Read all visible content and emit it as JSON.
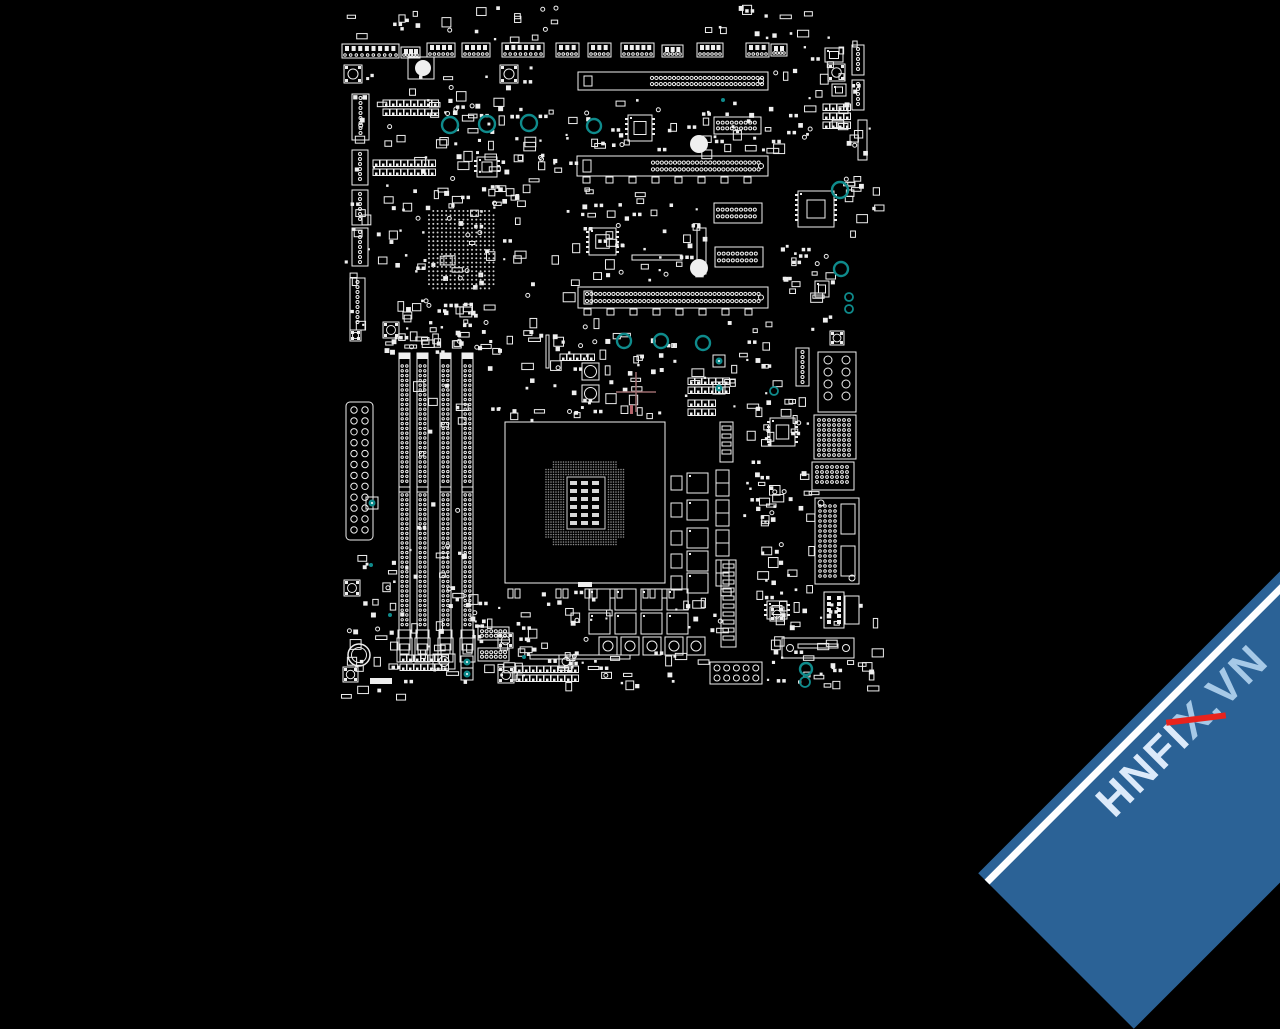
{
  "meta": {
    "background_color": "#000000",
    "line_color": "#efefef",
    "dim_line_color": "#8c8c8c",
    "bga_dot_color": "#cfcfcf",
    "hole_color": "#0f8b8c",
    "crosshair_color": "#9b6b6e",
    "red_tick_color": "#b5646b"
  },
  "watermark": {
    "text_head": "HNFI",
    "text_x": "X",
    "text_tail": ".VN",
    "band_color": "#2b6296",
    "edge_color": "#ffffff",
    "head_color": "#dceafa",
    "light_color": "#a6c9e7",
    "slash_color": "#e8231d"
  },
  "board": {
    "seed": 42,
    "crosshair": {
      "x": 636,
      "y": 392,
      "arm": 20
    },
    "red_tick": [
      630,
      405,
      3,
      9
    ],
    "holes": [
      [
        450,
        125,
        8
      ],
      [
        487,
        124,
        8
      ],
      [
        529,
        123,
        8
      ],
      [
        594,
        126,
        7
      ],
      [
        624,
        341,
        7
      ],
      [
        661,
        341,
        7
      ],
      [
        703,
        343,
        7
      ],
      [
        840,
        190,
        8
      ],
      [
        841,
        269,
        7
      ],
      [
        806,
        669,
        6
      ],
      [
        805,
        682,
        5
      ],
      [
        849,
        297,
        4
      ],
      [
        849,
        309,
        4
      ],
      [
        774,
        391,
        4
      ]
    ],
    "tiny_teal": [
      [
        723,
        100
      ],
      [
        371,
        565
      ],
      [
        390,
        615
      ],
      [
        524,
        657
      ]
    ],
    "teal_boxes": [
      [
        713,
        355
      ],
      [
        713,
        382
      ],
      [
        461,
        656
      ],
      [
        461,
        668
      ],
      [
        366,
        497
      ]
    ],
    "top_connectors": [
      [
        342,
        44,
        57,
        14,
        8
      ],
      [
        401,
        47,
        19,
        11,
        3
      ],
      [
        427,
        43,
        28,
        14,
        4
      ],
      [
        462,
        43,
        28,
        14,
        4
      ],
      [
        502,
        43,
        42,
        14,
        6
      ],
      [
        556,
        43,
        23,
        14,
        3
      ],
      [
        588,
        43,
        23,
        14,
        3
      ],
      [
        621,
        43,
        33,
        14,
        5
      ],
      [
        662,
        45,
        21,
        12,
        3
      ],
      [
        697,
        43,
        26,
        14,
        4
      ],
      [
        746,
        43,
        23,
        14,
        3
      ],
      [
        771,
        44,
        16,
        12,
        2
      ]
    ],
    "left_connectors": [
      [
        352,
        94,
        17,
        46
      ],
      [
        352,
        150,
        16,
        35
      ],
      [
        352,
        190,
        16,
        35
      ],
      [
        352,
        228,
        16,
        38
      ],
      [
        350,
        278,
        15,
        52
      ],
      [
        852,
        45,
        12,
        30
      ],
      [
        852,
        80,
        12,
        30
      ],
      [
        796,
        348,
        13,
        38
      ]
    ],
    "pcie_slots": [
      {
        "x": 578,
        "y": 72,
        "w": 190,
        "h": 18,
        "dot_start": 74,
        "tabs": false
      },
      {
        "x": 577,
        "y": 156,
        "w": 191,
        "h": 20,
        "dot_start": 76,
        "tabs": true
      },
      {
        "x": 578,
        "y": 287,
        "w": 190,
        "h": 21,
        "dot_start": 9,
        "tabs": true
      }
    ],
    "dotted_connectors": [
      [
        714,
        117,
        47,
        17
      ],
      [
        714,
        203,
        48,
        20
      ],
      [
        715,
        247,
        48,
        20
      ],
      [
        478,
        627,
        31,
        13
      ],
      [
        478,
        648,
        31,
        13
      ]
    ],
    "bga": {
      "x": 427,
      "y": 209,
      "w": 72,
      "h": 82,
      "step": 4.3
    },
    "chips": [
      [
        628,
        115,
        24,
        26
      ],
      [
        589,
        228,
        27,
        27
      ],
      [
        798,
        191,
        36,
        36
      ],
      [
        770,
        418,
        25,
        28
      ],
      [
        815,
        281,
        14,
        16
      ],
      [
        825,
        48,
        18,
        14
      ],
      [
        832,
        84,
        14,
        12
      ],
      [
        767,
        601,
        20,
        18
      ],
      [
        477,
        157,
        20,
        20
      ]
    ],
    "dimm": {
      "xs": [
        399,
        417,
        440,
        462
      ],
      "y": 353,
      "h": 297,
      "w": 11,
      "notch": 487
    },
    "atx": {
      "x": 346,
      "y": 402,
      "w": 27,
      "h": 138,
      "rows": 12
    },
    "socket": {
      "x": 505,
      "y": 422,
      "w": 160,
      "h": 161,
      "grid": [
        546,
        462,
        80,
        86
      ],
      "island": [
        567,
        477,
        38,
        52
      ]
    },
    "pad_pairs": [
      [
        508,
        589
      ],
      [
        556,
        589
      ],
      [
        585,
        589
      ],
      [
        610,
        589
      ],
      [
        643,
        589
      ],
      [
        662,
        589
      ]
    ],
    "pad_grids": [
      [
        383,
        100,
        8,
        2
      ],
      [
        373,
        160,
        9,
        2
      ],
      [
        400,
        655,
        7,
        2
      ],
      [
        823,
        104,
        4,
        3
      ],
      [
        688,
        378,
        6,
        2
      ],
      [
        688,
        400,
        4,
        2
      ],
      [
        516,
        666,
        9,
        2
      ],
      [
        560,
        354,
        5,
        1
      ]
    ],
    "vrm": {
      "fets": {
        "x": 687,
        "w": 21,
        "h": 20,
        "ys": [
          473,
          500,
          528,
          551,
          573
        ]
      },
      "small": {
        "x": 671,
        "w": 11,
        "h": 14,
        "ys": [
          476,
          503,
          531,
          554,
          576
        ]
      },
      "chokes": {
        "x": 716,
        "w": 13,
        "h": 26,
        "ys": [
          470,
          500,
          530,
          560
        ]
      },
      "strips": [
        [
          720,
          422,
          13,
          40
        ],
        [
          721,
          560,
          15,
          87
        ]
      ],
      "low_fets": {
        "ys": [
          589,
          613
        ],
        "xs": [
          589,
          615,
          641,
          667
        ],
        "w": 21,
        "h": 21
      },
      "low_chokes": {
        "y": 637,
        "xs": [
          599,
          621,
          643,
          665,
          687
        ],
        "w": 18,
        "h": 18
      }
    },
    "right_blocks": [
      [
        818,
        352,
        38,
        60,
        "circles2col"
      ],
      [
        814,
        415,
        42,
        44,
        "grid"
      ],
      [
        812,
        462,
        42,
        28,
        "grid"
      ],
      [
        815,
        498,
        44,
        86,
        "big"
      ],
      [
        824,
        592,
        20,
        36,
        "cols"
      ],
      [
        845,
        596,
        14,
        28,
        "plain"
      ]
    ],
    "usb_header": [
      710,
      662,
      52,
      22
    ],
    "bar": [
      782,
      638,
      72,
      20
    ],
    "buttons": [
      [
        344,
        65,
        18
      ],
      [
        500,
        65,
        18
      ],
      [
        828,
        64,
        17
      ],
      [
        830,
        331,
        14
      ],
      [
        383,
        322,
        16
      ],
      [
        350,
        330,
        11
      ],
      [
        344,
        580,
        16
      ],
      [
        343,
        667,
        15
      ],
      [
        498,
        667,
        16
      ],
      [
        498,
        633,
        15
      ],
      [
        770,
        607,
        14
      ]
    ],
    "circle_boxes": [
      [
        433,
        654,
        22,
        15,
        5
      ],
      [
        582,
        363,
        17,
        17,
        6
      ],
      [
        582,
        385,
        17,
        17,
        6
      ],
      [
        559,
        655,
        14,
        13,
        4
      ]
    ],
    "filled_circles": [
      [
        423,
        68,
        8
      ],
      [
        699,
        144,
        9
      ],
      [
        699,
        268,
        9
      ]
    ],
    "battery": [
      359,
      655,
      11
    ],
    "plain_rects": [
      [
        408,
        57,
        26,
        22,
        0
      ],
      [
        632,
        255,
        50,
        5,
        0
      ],
      [
        530,
        655,
        100,
        4,
        0
      ],
      [
        697,
        228,
        9,
        46,
        0
      ],
      [
        546,
        335,
        3,
        33,
        0
      ],
      [
        578,
        582,
        14,
        5,
        1
      ],
      [
        370,
        678,
        22,
        6,
        1
      ],
      [
        858,
        120,
        9,
        40,
        0
      ]
    ],
    "scatter_regions": [
      [
        342,
        10,
        85,
        28,
        8
      ],
      [
        440,
        5,
        125,
        35,
        14
      ],
      [
        700,
        5,
        115,
        32,
        12
      ],
      [
        344,
        60,
        190,
        290,
        150
      ],
      [
        380,
        300,
        115,
        52,
        26
      ],
      [
        540,
        95,
        36,
        250,
        16
      ],
      [
        578,
        98,
        195,
        52,
        40
      ],
      [
        578,
        186,
        128,
        95,
        42
      ],
      [
        440,
        95,
        105,
        110,
        30
      ],
      [
        578,
        318,
        85,
        100,
        22
      ],
      [
        664,
        318,
        110,
        92,
        26
      ],
      [
        772,
        25,
        100,
        120,
        30
      ],
      [
        772,
        235,
        60,
        95,
        22
      ],
      [
        762,
        395,
        48,
        200,
        34
      ],
      [
        770,
        600,
        105,
        58,
        22
      ],
      [
        345,
        545,
        150,
        140,
        55
      ],
      [
        482,
        585,
        125,
        95,
        32
      ],
      [
        482,
        330,
        58,
        95,
        16
      ],
      [
        545,
        345,
        118,
        68,
        22
      ],
      [
        500,
        640,
        200,
        45,
        28
      ],
      [
        735,
        420,
        33,
        160,
        16
      ],
      [
        410,
        370,
        50,
        268,
        20
      ],
      [
        385,
        330,
        88,
        22,
        10
      ],
      [
        666,
        585,
        55,
        50,
        12
      ],
      [
        765,
        655,
        110,
        33,
        20
      ],
      [
        340,
        686,
        60,
        10,
        4
      ],
      [
        840,
        120,
        35,
        115,
        18
      ],
      [
        752,
        430,
        22,
        170,
        14
      ]
    ]
  }
}
